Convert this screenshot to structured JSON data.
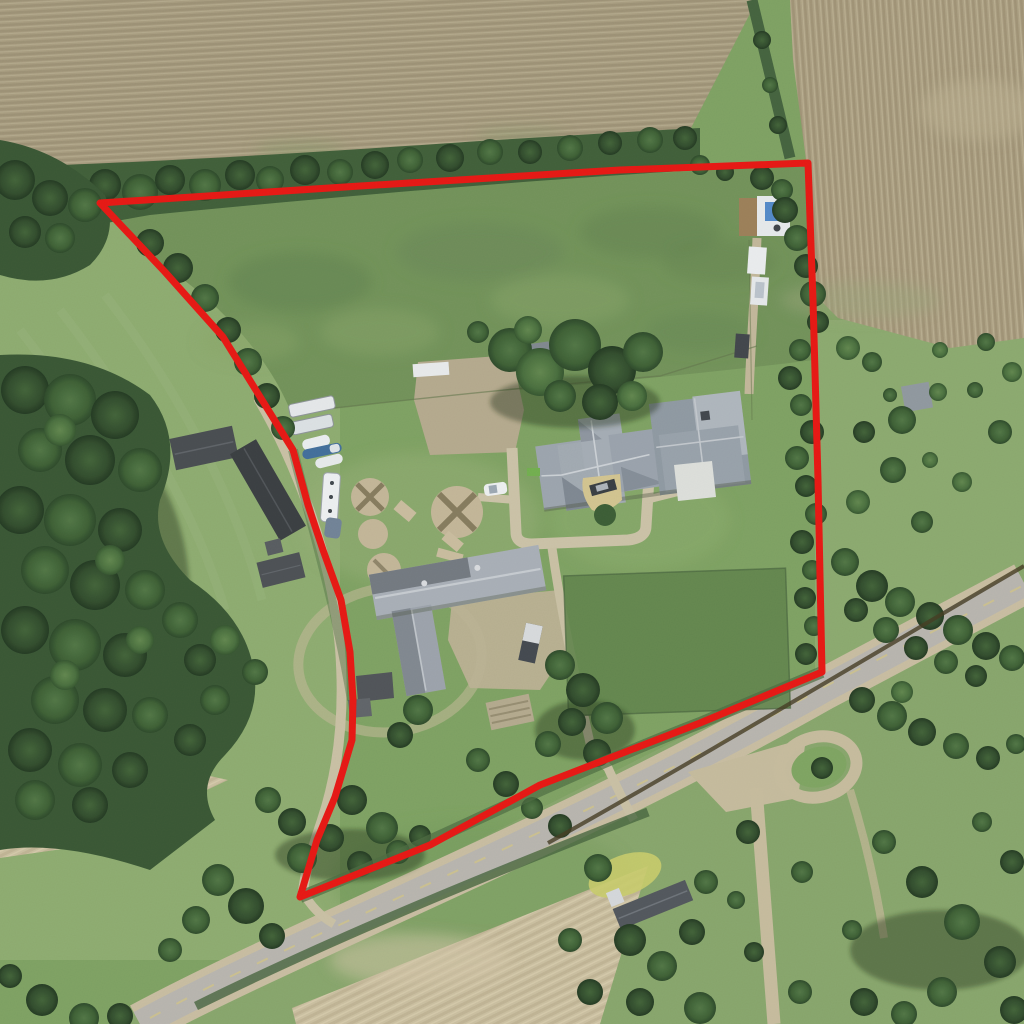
{
  "scene": {
    "kind": "satellite-aerial-photo",
    "description": "Aerial satellite view of a rural farm property outlined with a red parcel boundary. Plowed tan fields at top and bottom, green pasture and lawns, farmstead with house, pole barn, large L-shaped barn, gravel circle pads, parked RVs and boats, a paved country road crossing the lower portion, and a looped gravel driveway at right."
  },
  "boundary": {
    "color": "#e8100c",
    "stroke_width": 7,
    "points_str": "100,203 360,186 620,170 808,163 813,300 818,480 822,672 700,723 540,785 430,845 300,897 317,840 335,797 352,740 353,700 350,652 341,600 323,550 308,505 293,450 223,337 165,272"
  },
  "palette": {
    "plowed_field": "#a79b7d",
    "plowed_field_right": "#ab9e80",
    "stubble_field": "#cbbf9f",
    "meadow": "#6f9156",
    "pasture": "#8cab6d",
    "lawn": "#7ca15f",
    "tree_dark": "#2d4a28",
    "tree_light": "#5a8148",
    "road_asphalt": "#b7b4ae",
    "road_shoulder": "#c8bda0",
    "gravel_drive": "#c9c0a3",
    "roof_gray": "#9aa3ad",
    "roof_dark": "#43474c",
    "white_vehicle": "#eceef0",
    "boat_blue": "#3d6a99",
    "pool_blue": "#4e86c8"
  },
  "map_features": [
    "property-boundary-outline",
    "plowed-field-north",
    "plowed-field-northeast",
    "stubble-field-southwest",
    "stubble-field-south",
    "meadow-inside-boundary",
    "west-pasture",
    "east-pasture",
    "dark-paddock",
    "north-tree-belt",
    "west-forest",
    "east-tree-belt",
    "farm-house",
    "pole-barn",
    "large-barn",
    "barn-lean-to",
    "west-outbuilding-1",
    "west-outbuilding-2",
    "west-outbuilding-3",
    "northeast-deck-with-pool",
    "south-neighbor-house",
    "east-shed",
    "gravel-circle-pads",
    "campers",
    "boats",
    "rv",
    "white-car",
    "utility-trailer",
    "main-road",
    "farm-driveway-west",
    "south-farm-driveway",
    "loop-driveway-east"
  ]
}
